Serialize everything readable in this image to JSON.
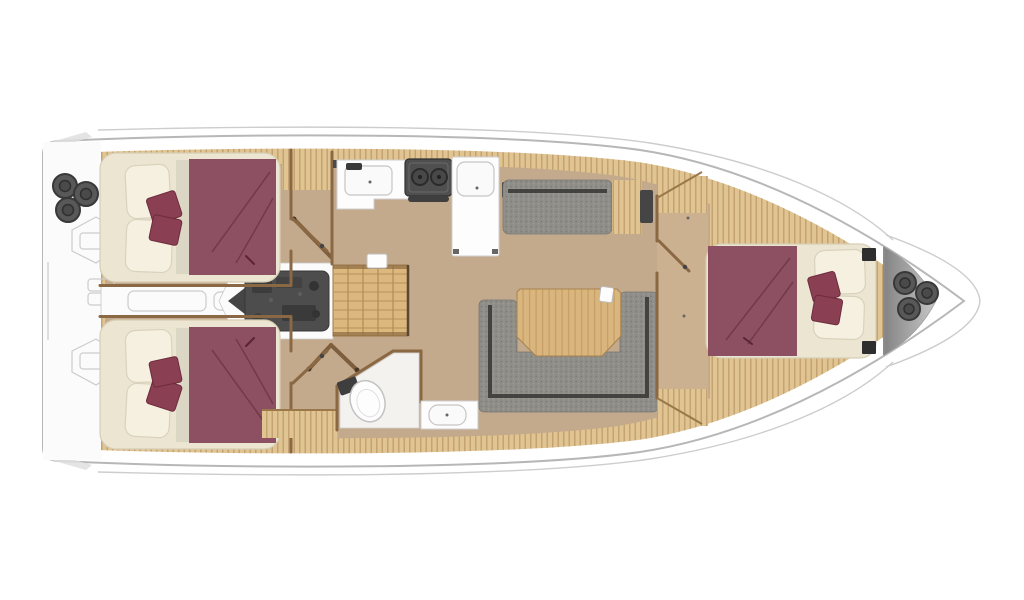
{
  "diagram": {
    "type": "yacht-floor-plan",
    "view": "top-down",
    "bow_direction": "right",
    "regions": [
      "stern-platform",
      "aft-cabin-port",
      "aft-cabin-starboard",
      "center-passage",
      "engine-compartment",
      "companionway-stairs",
      "galley",
      "head-bathroom",
      "salon",
      "forward-cabin",
      "bow-anchor-locker"
    ],
    "furniture": [
      "double-bed-aft-port",
      "double-bed-aft-starboard",
      "double-bed-forward",
      "u-shaped-settee",
      "straight-settee",
      "salon-table",
      "galley-counter-sink",
      "stove",
      "fridge-unit",
      "toilet",
      "vanity-sink",
      "engine-block",
      "stern-winches",
      "bow-winches"
    ],
    "counts": {
      "cabins": 3,
      "beds": 3,
      "winch_circles_stern": 3,
      "winch_circles_bow": 3
    }
  },
  "colors": {
    "background": "#ffffff",
    "hull_fill": "#ffffff",
    "hull_stroke": "#b7b7b7",
    "outline_light": "#cdcdcd",
    "deck_wood": "#e0c492",
    "deck_wood_line": "#a97f4f",
    "floor_wood": "#c4aa8c",
    "floor_wood_light": "#ccb190",
    "table_wood": "#d9b67e",
    "table_wood_line": "#b98e55",
    "stair_wood": "#ddb87e",
    "wall_wood": "#8a6844",
    "bed_maroon": "#8d5062",
    "pillow_maroon": "#8a3f53",
    "pillow_maroon_edge": "#6d2c3d",
    "mattress_cream": "#ece5d2",
    "pillow_cream": "#f5f0e0",
    "pillow_cream_edge": "#d9d2bc",
    "upholstery_gray": "#8f8d88",
    "upholstery_dot_dark": "#7d7b76",
    "upholstery_dot_light": "#9e9c97",
    "upholstery_seam": "#3b3b38",
    "appliance_white": "#fdfdfd",
    "appliance_stroke": "#cfcfcf",
    "stove_gray": "#4f4f4f",
    "engine_gray": "#4d4d4d",
    "metal_dark": "#3f3f3f",
    "winch_gray": "#585858",
    "locker_gradient_dark": "#848484",
    "locker_gradient_light": "#e6e6e6"
  }
}
